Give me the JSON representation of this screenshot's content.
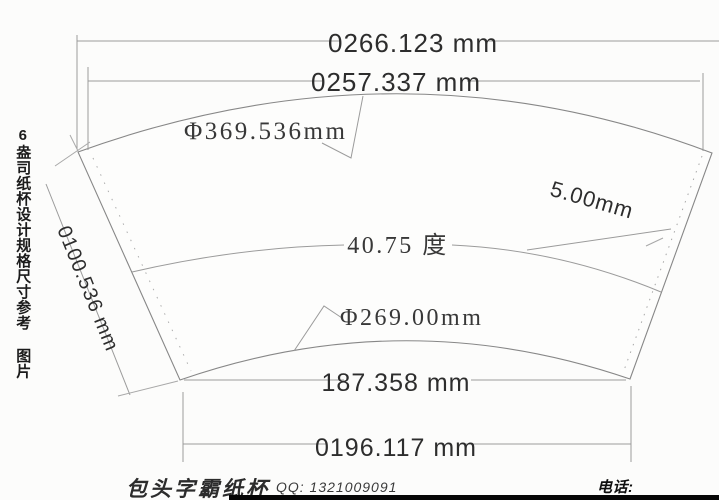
{
  "side_caption": "6盎司纸杯设计规格尺寸参考 图片",
  "labels": {
    "outer_width": "0266.123 mm",
    "mouth_width": "0257.337 mm",
    "outer_diameter": "Φ369.536mm",
    "seam_width": "5.00mm",
    "angle": "40.75 度",
    "inner_diameter": "Φ269.00mm",
    "bottom_chord": "187.358 mm",
    "bottom_width": "0196.117 mm",
    "slant_height": "0100.536 mm"
  },
  "footer": {
    "brand": "包头字霸纸杯",
    "qq": "QQ: 1321009091",
    "phone": "电话: 13009561686"
  },
  "colors": {
    "background": "#fcfcfb",
    "outline": "#878787",
    "dim_line": "#9b9b9b",
    "text": "#2d2d2d",
    "bottom_bar": "#060606"
  }
}
